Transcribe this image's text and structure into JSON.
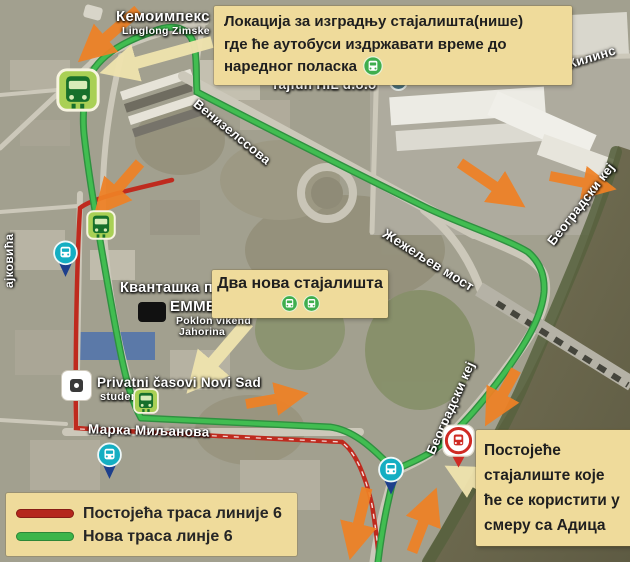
{
  "callouts": {
    "niche": {
      "lines": [
        "Локација за изградњу стајалишта(нише)",
        "где ће аутобуси издржавати време до",
        "наредног поласка"
      ]
    },
    "two_stops": {
      "text": "Два нова стајалишта"
    },
    "existing_stop": {
      "lines": [
        "Постојеће",
        "стајалиште које",
        "ће се користити у",
        "смеру са Адица"
      ]
    }
  },
  "legend": {
    "items": [
      {
        "label": "Постојећа траса линије 6",
        "color": "#b5271d"
      },
      {
        "label": "Нова траса линје 6",
        "color": "#3cb54a"
      }
    ]
  },
  "map_labels": {
    "kemoimpeks": "Кемоимпекс",
    "linglong": "Linglong Zimske",
    "tajfun": "Tajfun HIL d.o.o",
    "venizelosova": "Венизелссова",
    "zezeljev_most": "Жежељев мост",
    "beogradski_kej_1": "Београдски кеј",
    "beogradski_kej_2": "Београдски кеј",
    "zilinska": "ни Жилинс",
    "rajkovica": "ајковића",
    "marka_miljanova": "Марка Миљанова",
    "kvantaska": "Кванташка п",
    "emmezeta": "EMME",
    "poklon_1": "Poklon vikend",
    "poklon_2": "Jahorina",
    "privatni": "Privatni časovi Novi Sad",
    "studen": "studen"
  },
  "colors": {
    "callout_bg": "#efdb9b",
    "route_existing": "#bf2a1e",
    "route_new": "#3cb54a",
    "arrow_orange": "#ef8125",
    "river": "#6f6c52"
  }
}
